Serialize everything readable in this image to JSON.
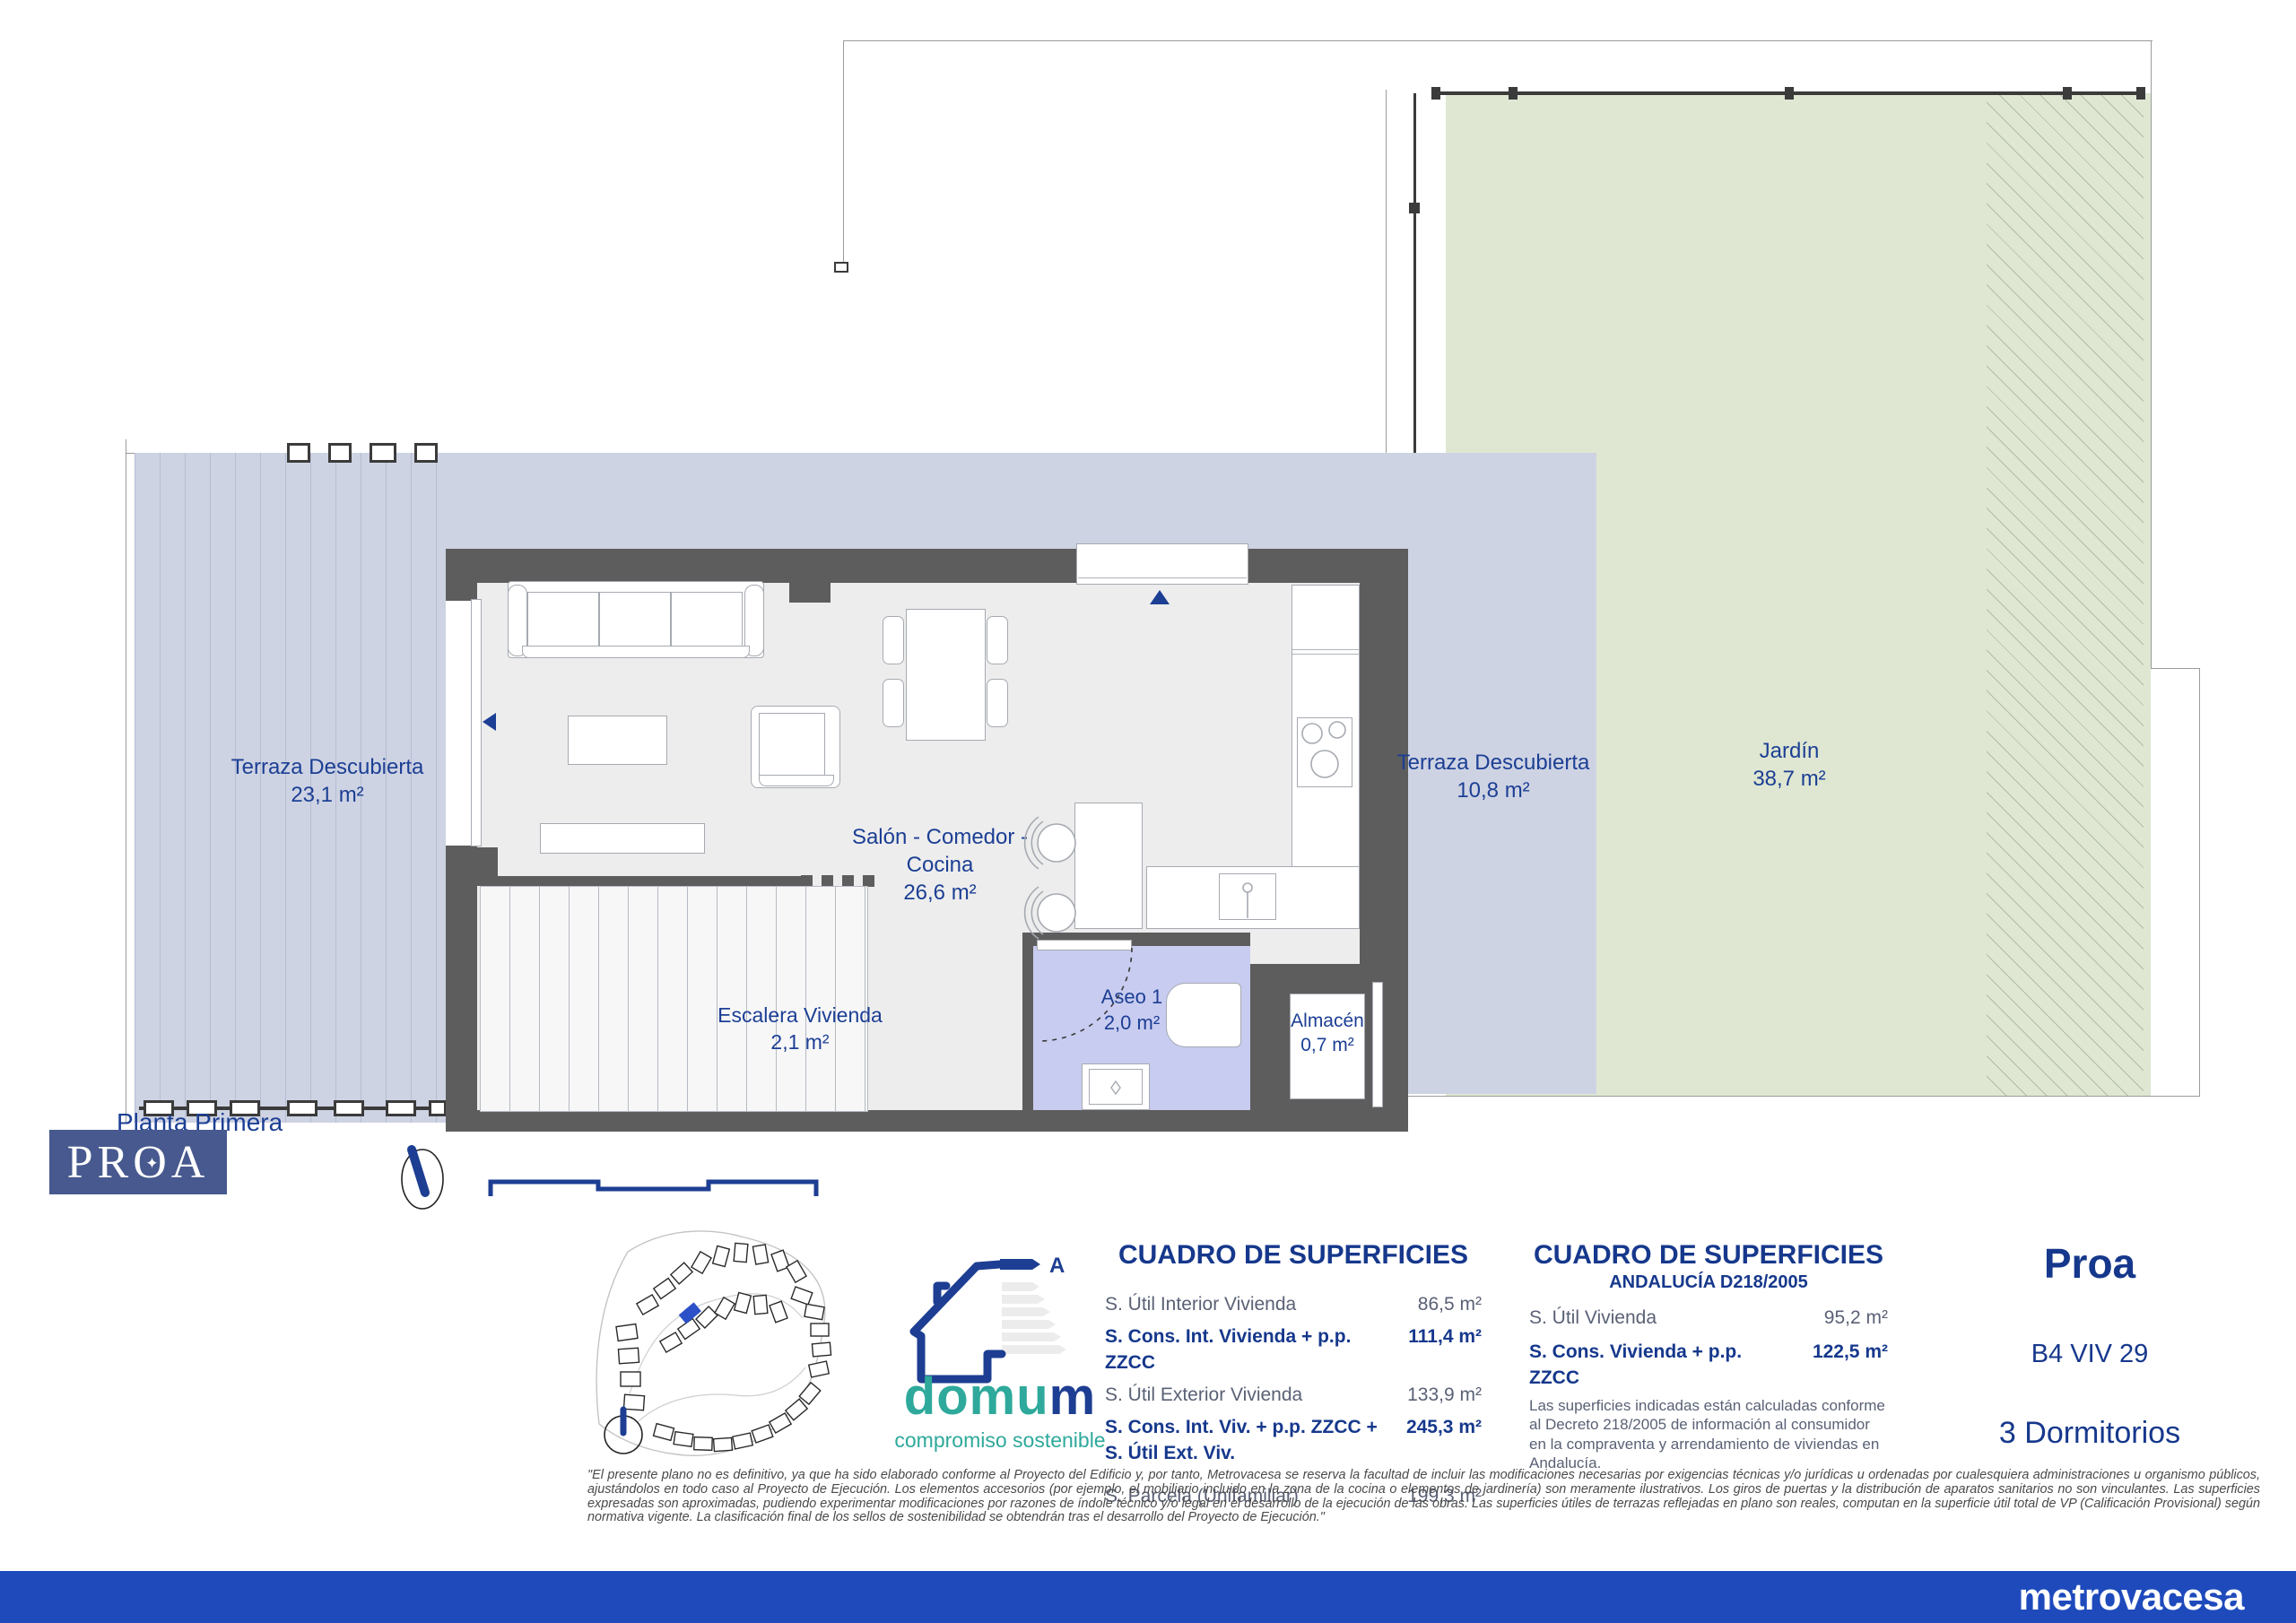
{
  "page": {
    "floor_label": "Planta Primera"
  },
  "plan": {
    "rooms": {
      "terraza_izq": {
        "name": "Terraza Descubierta",
        "area": "23,1 m²"
      },
      "salon": {
        "name_line1": "Salón - Comedor -",
        "name_line2": "Cocina",
        "area": "26,6 m²"
      },
      "escalera": {
        "name": "Escalera Vivienda",
        "area": "2,1 m²"
      },
      "aseo": {
        "name": "Aseo 1",
        "area": "2,0 m²"
      },
      "almacen": {
        "name": "Almacén",
        "area": "0,7 m²"
      },
      "terraza_dcha": {
        "name": "Terraza Descubierta",
        "area": "10,8 m²"
      },
      "jardin": {
        "name": "Jardín",
        "area": "38,7 m²"
      }
    }
  },
  "branding": {
    "proa_pr": "PR",
    "proa_o": "O",
    "proa_a": "A",
    "proa_star": "✦",
    "energy_class": "A",
    "domum_prefix": "domu",
    "domum_suffix": "m",
    "domum_tagline": "compromiso sostenible"
  },
  "tables": {
    "general": {
      "title": "CUADRO DE SUPERFICIES",
      "rows": [
        {
          "label": "S. Útil Interior Vivienda",
          "value": "86,5 m²"
        },
        {
          "label": "S. Cons. Int. Vivienda + p.p. ZZCC",
          "value": "111,4 m²"
        },
        {
          "label": "S. Útil Exterior Vivienda",
          "value": "133,9 m²"
        },
        {
          "label": "S. Cons. Int. Viv. + p.p. ZZCC + S. Útil Ext. Viv.",
          "value": "245,3 m²"
        },
        {
          "label": "S. Parcela (Unifamiliar)",
          "value": "199,3 m²"
        }
      ]
    },
    "andalucia": {
      "title": "CUADRO DE SUPERFICIES",
      "subtitle": "ANDALUCÍA D218/2005",
      "rows": [
        {
          "label": "S. Útil Vivienda",
          "value": "95,2 m²"
        },
        {
          "label": "S. Cons. Vivienda + p.p. ZZCC",
          "value": "122,5 m²"
        }
      ],
      "note": "Las superficies indicadas están calculadas conforme al Decreto 218/2005 de información al consumidor en la compraventa y arrendamiento de viviendas en Andalucía."
    }
  },
  "unit": {
    "name": "Proa",
    "code": "B4 VIV 29",
    "bedrooms": "3 Dormitorios"
  },
  "disclaimer": "\"El presente plano no es definitivo, ya que ha sido elaborado conforme al Proyecto del Edificio y, por tanto, Metrovacesa se reserva la facultad de incluir las modificaciones necesarias por exigencias técnicas y/o jurídicas u ordenadas por cualesquiera administraciones u organismo públicos, ajustándolos en todo caso al Proyecto de Ejecución. Los elementos accesorios (por ejemplo, el mobiliario incluido en la zona de la cocina o elementos de jardinería) son meramente ilustrativos. Los giros de puertas y la distribución de aparatos sanitarios no son vinculantes. Las superficies expresadas son aproximadas, pudiendo experimentar modificaciones por razones de índole técnico y/o legal en el desarrollo de la ejecución de las obras. Las superficies útiles de terrazas reflejadas en plano son reales, computan en la superficie útil total de VP (Calificación Provisional) según normativa vigente. La clasificación final de los sellos de sostenibilidad se obtendrán tras el desarrollo del Proyecto de Ejecución.\"",
  "footer": {
    "brand": "metrovacesa"
  },
  "colors": {
    "accent_navy": "#1c3f94",
    "table_navy": "#16388c",
    "footer_blue": "#1e4abc",
    "terrace_lavender": "#ced3e3",
    "aseo_lavender": "#c8ccf0",
    "garden_green": "#dfe7d2",
    "wall_gray": "#5d5d5d",
    "domum_teal": "#2ea99b",
    "proa_box_blue": "#47598e"
  }
}
